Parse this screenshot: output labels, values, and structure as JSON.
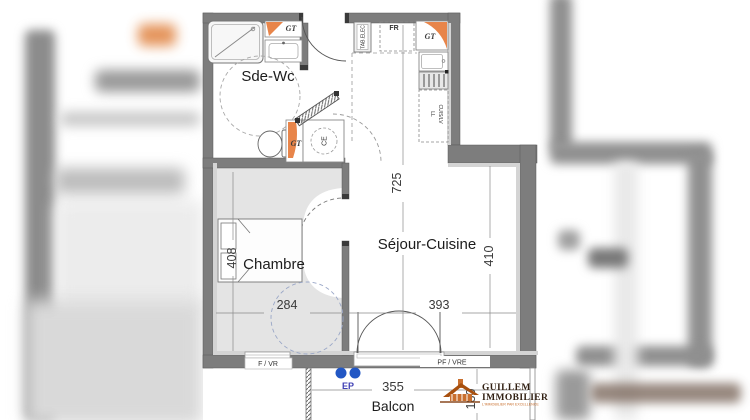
{
  "plan": {
    "rooms": {
      "sde_wc": "Sde-Wc",
      "chambre": "Chambre",
      "sejour_cuisine": "Séjour-Cuisine",
      "balcon": "Balcon"
    },
    "dimensions_cm": {
      "sejour_length": "725",
      "sejour_width": "410",
      "chambre_length": "408",
      "chambre_width": "284",
      "sejour_bottom_width": "393",
      "balcon_width": "355",
      "balcon_depth": "180"
    },
    "annotations": {
      "gt": "GT",
      "fr": "FR",
      "tab_elec": "TAB.ELEC",
      "ce": "CE",
      "cuis_lv": "CUIS/LV",
      "ll": "LL",
      "window_left": "F / VR",
      "window_right": "PF / VRE",
      "ep": "EP"
    }
  },
  "logo": {
    "name_line1": "GUILLEM",
    "name_line2": "IMMOBILIER",
    "tagline": "L'IMMOBILIER PAR EXCELLENCE"
  },
  "colors": {
    "wall": "#7d7d7d",
    "gt_orange": "#e8854a",
    "floor_gray": "#e4e4e4",
    "ep_blue": "#2257c4",
    "logo_brown": "#301f12",
    "logo_orange": "#c96f2e"
  }
}
